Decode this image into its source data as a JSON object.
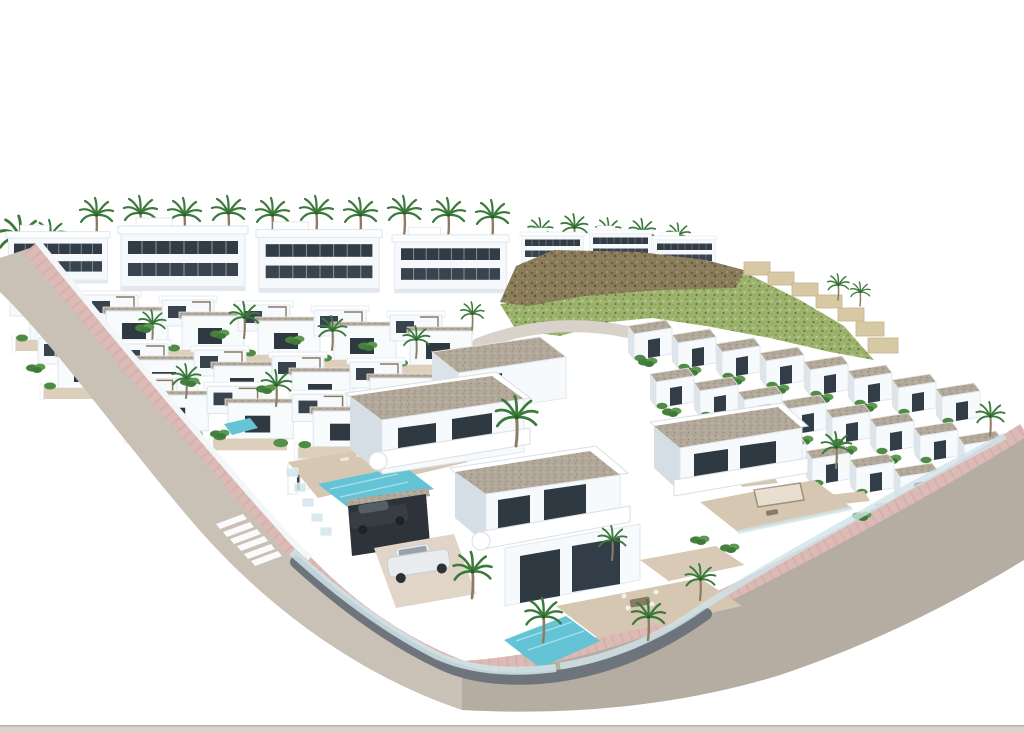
{
  "meta": {
    "description": "Aerial 3D architectural render of a Mediterranean-style residential development: rows of white modern villas and townhouses with dark ribbon glazing, gravel flat roofs, roof terraces, palm trees, private pools, a rocky hillside with green scrub, stepped beige retaining walls, and curving streets with pink paved sidewalks and a zebra crosswalk, isolated on a pure white background",
    "visible_text": "none"
  },
  "palette": {
    "background": "#ffffff",
    "wall_white": "#f7fafc",
    "wall_shade": "#dfe6ec",
    "wall_side": "#d6dee5",
    "glazing_dark": "#2f3942",
    "roof_gravel": "#b2a99b",
    "terrace_beige": "#d6c7b2",
    "road_main": "#c9c0b6",
    "road_lower": "#b5aca2",
    "hill_road": "#d8d2ca",
    "sidewalk_pink": "#dcbab6",
    "sidewalk_joint": "#cfa5a2",
    "crosswalk": "#ffffff",
    "pool_water": "#64c4d6",
    "pool_ripple": "#a7e0ea",
    "palm_frond": "#3c7a3c",
    "palm_trunk": "#8d7c64",
    "shrub": "#4e8c46",
    "hill_rock": "#8a7b5b",
    "hill_scrub": "#9cb26d",
    "terrace_wall": "#d8c9a5",
    "retaining_wall": "#6e747b",
    "glass_fence": "#cfe4ea",
    "car_white": "#e9ecee",
    "car_dark": "#383d44",
    "ground_strip": "#d8d3cc"
  },
  "scene": {
    "setting": "aerial three-quarter view on white background",
    "areas": {
      "back_row_apartments": {
        "buildings": 4,
        "features": [
          "two dark ribbon glazing bands",
          "roof boxes",
          "palms behind"
        ]
      },
      "hilltop_houses": {
        "buildings": 3
      },
      "hillside": {
        "features": [
          "rocky crest",
          "green scrub slope",
          "stepped beige retaining walls",
          "small access road at base"
        ]
      },
      "mid_villa_rows": {
        "rows": [
          6,
          5,
          3
        ],
        "features": [
          "roof terraces",
          "pergolas",
          "gardens",
          "small pool"
        ]
      },
      "right_townhouse_rows": {
        "rows": [
          8,
          8,
          6
        ],
        "features": [
          "gravel flat roofs",
          "garden courtyards",
          "terrace strip"
        ]
      },
      "foreground_villas": {
        "villas": 3,
        "features": [
          "gravel flat roofs",
          "curved white balconies",
          "terraces with furniture",
          "private pools",
          "glass pool fences",
          "carport",
          "driveway"
        ]
      }
    },
    "roads": {
      "left_road": "curving street from upper left to bottom corner with pink sidewalk and zebra crosswalk",
      "right_road": "wide street along lower-right edge fading to white",
      "hill_road": "small pale access road at hill base",
      "bottom_ground_strip": "thin warm-gray strip across very bottom edge"
    },
    "objects": {
      "palm_trees": 36,
      "pools": 3,
      "sun_loungers": 4,
      "cars": 2,
      "car_types": [
        "white SUV on driveway",
        "dark car under carport"
      ],
      "crosswalk_stripes": 6,
      "entrance_gates": 1
    }
  }
}
